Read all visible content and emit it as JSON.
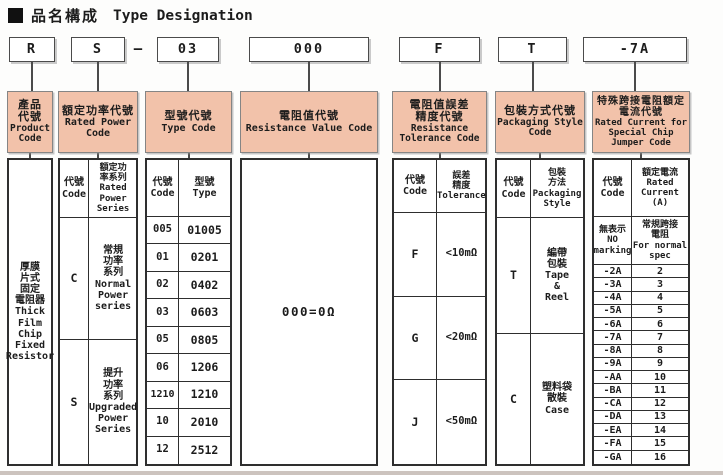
{
  "title": {
    "marker": "■",
    "cjk": "品名構成",
    "en": "Type Designation"
  },
  "colors": {
    "header_bg": "#f2c2aa",
    "header_border": "#858585",
    "table_border": "#2e2e2e",
    "code_box_border": "#4b4b4b"
  },
  "code_row": {
    "product": "R",
    "power": "S",
    "separator": "—",
    "type": "03",
    "resistance": "000",
    "tolerance": "F",
    "packaging": "T",
    "jumper": "-7A"
  },
  "product_col": {
    "header_cjk": "產品\n代號",
    "header_en": "Product\nCode",
    "body": "厚膜\n片式\n固定\n電阻器\nThick\nFilm\nChip\nFixed\nResistor"
  },
  "power_col": {
    "header_cjk": "額定功率代號",
    "header_en": "Rated Power\nCode",
    "code_label": "代號\nCode",
    "series_label": "額定功\n率系列\nRated\nPower\nSeries",
    "rows": [
      {
        "code": "C",
        "desc": "常規\n功率\n系列\nNormal\nPower\nseries"
      },
      {
        "code": "S",
        "desc": "提升\n功率\n系列\nUpgraded\nPower\nSeries"
      }
    ]
  },
  "type_col": {
    "header_cjk": "型號代號",
    "header_en": "Type Code",
    "code_label": "代號\nCode",
    "type_label": "型號\nType",
    "rows": [
      {
        "code": "005",
        "type": "01005"
      },
      {
        "code": "01",
        "type": "0201"
      },
      {
        "code": "02",
        "type": "0402"
      },
      {
        "code": "03",
        "type": "0603"
      },
      {
        "code": "05",
        "type": "0805"
      },
      {
        "code": "06",
        "type": "1206"
      },
      {
        "code": "1210",
        "type": "1210"
      },
      {
        "code": "10",
        "type": "2010"
      },
      {
        "code": "12",
        "type": "2512"
      }
    ]
  },
  "resistance_col": {
    "header_cjk": "電阻值代號",
    "header_en": "Resistance Value Code",
    "body": "000=0Ω"
  },
  "tolerance_col": {
    "header_cjk": "電阻值誤差\n精度代號",
    "header_en": "Resistance\nTolerance Code",
    "code_label": "代號\nCode",
    "tol_label": "誤差\n精度\nTolerance",
    "rows": [
      {
        "code": "F",
        "tol": "<10mΩ"
      },
      {
        "code": "G",
        "tol": "<20mΩ"
      },
      {
        "code": "J",
        "tol": "<50mΩ"
      }
    ]
  },
  "packaging_col": {
    "header_cjk": "包裝方式代號",
    "header_en": "Packaging Style\nCode",
    "code_label": "代號\nCode",
    "style_label": "包裝\n方法\nPackaging\nStyle",
    "rows": [
      {
        "code": "T",
        "desc": "編帶\n包裝\nTape\n&\nReel"
      },
      {
        "code": "C",
        "desc": "塑料袋\n散裝\nCase"
      }
    ]
  },
  "jumper_col": {
    "header_cjk": "特殊跨接電阻額定\n電流代號",
    "header_en": "Rated Current for\nSpecial Chip\nJumper Code",
    "code_label": "代號\nCode",
    "current_label": "額定電流\nRated\nCurrent\n(A)",
    "no_marking_code": "無表示\nNO\nmarking",
    "no_marking_desc": "常規跨接\n電阻\nFor normal\nspec",
    "rows": [
      {
        "code": "-2A",
        "current": "2"
      },
      {
        "code": "-3A",
        "current": "3"
      },
      {
        "code": "-4A",
        "current": "4"
      },
      {
        "code": "-5A",
        "current": "5"
      },
      {
        "code": "-6A",
        "current": "6"
      },
      {
        "code": "-7A",
        "current": "7"
      },
      {
        "code": "-8A",
        "current": "8"
      },
      {
        "code": "-9A",
        "current": "9"
      },
      {
        "code": "-AA",
        "current": "10"
      },
      {
        "code": "-BA",
        "current": "11"
      },
      {
        "code": "-CA",
        "current": "12"
      },
      {
        "code": "-DA",
        "current": "13"
      },
      {
        "code": "-EA",
        "current": "14"
      },
      {
        "code": "-FA",
        "current": "15"
      },
      {
        "code": "-GA",
        "current": "16"
      }
    ]
  }
}
